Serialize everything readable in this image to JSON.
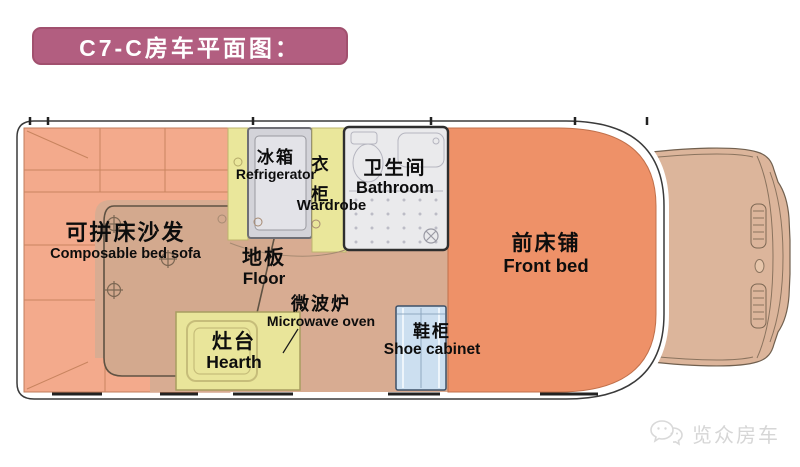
{
  "title": "C7-C房车平面图：",
  "plan": {
    "labels": {
      "sofa": {
        "zh": "可拼床沙发",
        "en": "Composable bed sofa"
      },
      "refrigerator": {
        "zh": "冰箱",
        "en": "Refrigerator"
      },
      "wardrobe": {
        "zh": "衣柜",
        "en": "Wardrobe"
      },
      "bathroom": {
        "zh": "卫生间",
        "en": "Bathroom"
      },
      "floor": {
        "zh": "地板",
        "en": "Floor"
      },
      "microwave": {
        "zh": "微波炉",
        "en": "Microwave oven"
      },
      "hearth": {
        "zh": "灶台",
        "en": "Hearth"
      },
      "shoe_cabinet": {
        "zh": "鞋柜",
        "en": "Shoe cabinet"
      },
      "front_bed": {
        "zh": "前床铺",
        "en": "Front bed"
      }
    }
  },
  "watermark": {
    "text": "览众房车"
  },
  "colors": {
    "banner": "#b25e80",
    "sofa": "#f3aa8c",
    "front_bed": "#ee9168",
    "floor": "#d8ac92",
    "table": "#d3a98e",
    "kitchen_yellow": "#eae79b",
    "refrigerator_grey": "#d3d3d9",
    "bathroom_grey": "#eaeaec",
    "shoe_cabinet_blue": "#ccdff0",
    "cab": "#dcb59b",
    "outline": "#3a3a3a",
    "label_text": "#0d0d0d",
    "watermark_grey": "#d6d6d6"
  }
}
